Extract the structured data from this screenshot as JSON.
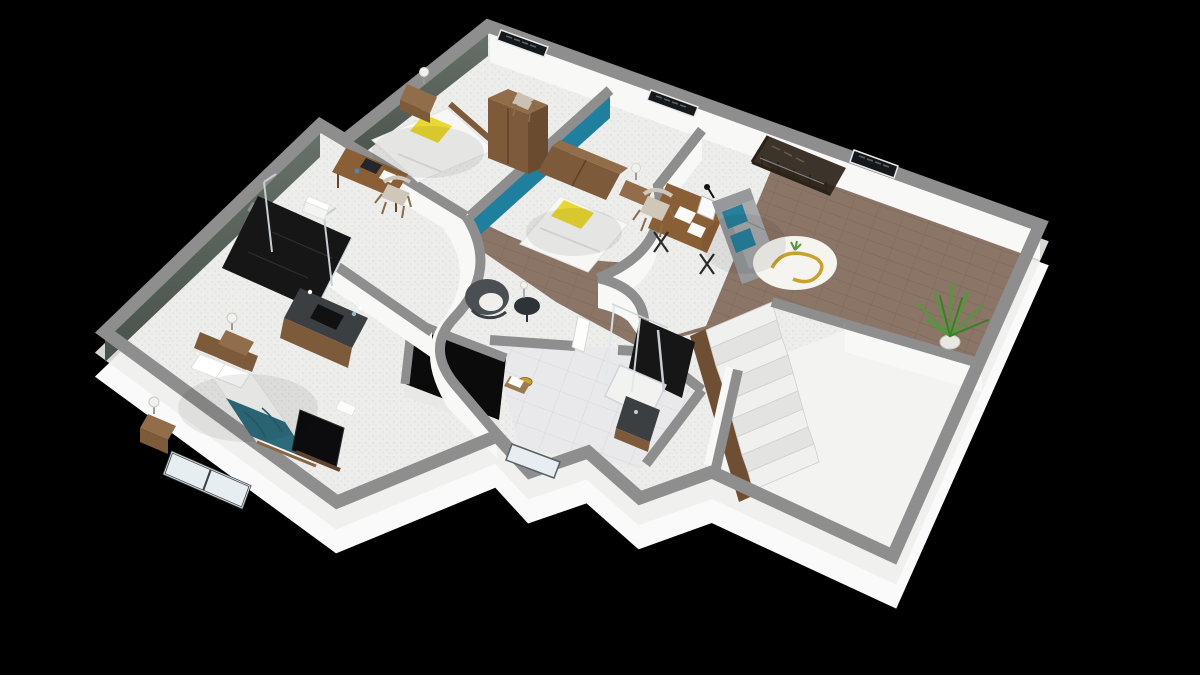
{
  "scene": {
    "type": "isometric-3d-floor-plan",
    "description": "3D dollhouse cutaway render of an upper storey, viewed from above at an angle on a black background",
    "background": "#000000",
    "level": "upper floor with stair landing"
  },
  "palette": {
    "background": "#000000",
    "wall-top": "#8e8e8e",
    "wall-face": "#f8f8f7",
    "plinth": "#fafafa",
    "floor-white": "#ededeb",
    "floor-speckle": "#d9d9d6",
    "wood-floor": "#8b7566",
    "wood-line": "#79665a",
    "tile-floor": "#e9e9eb",
    "tile-line": "#d7d7da",
    "empty-room-floor": "#f3f3f1",
    "sage-wall": "#5e6a61",
    "sage-wall-dark": "#49524b",
    "teal-wall": "#1e7f9f",
    "yellow-pillow": "#e9d832",
    "bed-white": "#f7f7f5",
    "blanket-teal": "#2e6b7a",
    "wood-furniture": "#7c5a3a",
    "wood-furniture-light": "#926d49",
    "sofa-gray": "#97989a",
    "sofa-seat": "#a8a9ab",
    "teal-pillow": "#26809b",
    "shower-black": "#161616",
    "chrome": "#c9cdd2",
    "glass": "#e6eef1",
    "stair-tread": "#f0f0ef",
    "stair-tread-alt": "#e3e3e1",
    "stair-stringer": "#6f4f33",
    "railing-dark": "#2b2218",
    "plant-green": "#55973c",
    "plant-green-dark": "#3f7a2c",
    "gold": "#c9a22a",
    "armchair-gray": "#4b4e52",
    "cushion-white": "#f0efec",
    "tv-black": "#0c0c0e",
    "counter-dark": "#3c3f42",
    "rug-white": "#f6f4ef"
  },
  "rooms": [
    {
      "id": "bedroom-1",
      "label": "bedroom 1 (top left)",
      "floor": "white speckled",
      "items": [
        "single bed, white duvet, yellow pillow",
        "nightstand with lamp",
        "desk with papers and laptop",
        "chair",
        "tall wardrobe",
        "high chair"
      ]
    },
    {
      "id": "bedroom-2",
      "label": "bedroom 2 (top middle)",
      "floor": "white speckled",
      "items": [
        "single bed, white duvet, yellow pillow",
        "tall wood headboard against teal accent wall",
        "nightstand with lamp"
      ]
    },
    {
      "id": "study-lounge",
      "label": "open study / lounge",
      "floor": "white speckled",
      "items": [
        "desk with monitor, papers and black lamp",
        "chair",
        "gray sofa with two teal pillows"
      ]
    },
    {
      "id": "living-landing",
      "label": "living landing (right wing)",
      "floor": "wood planks",
      "items": [
        "round white rug with bronze spiral sculpture",
        "potted plant",
        "stair void with dark glass railing"
      ]
    },
    {
      "id": "bathroom",
      "label": "bathroom (left)",
      "floor": "white speckled",
      "items": [
        "black tiled walk-in shower with chrome posts",
        "dark counter vanity with sink",
        "towel stack"
      ]
    },
    {
      "id": "master-bedroom",
      "label": "master bedroom (bottom left)",
      "floor": "white speckled",
      "items": [
        "double bed with teal throw blanket",
        "two nightstands with ball lamps",
        "TV leaning on stand",
        "large window on lower wall"
      ]
    },
    {
      "id": "shower-room",
      "label": "shower room (bottom middle)",
      "floor": "light tile",
      "items": [
        "glass shower with dark back panel and white tray",
        "dark vanity",
        "wood stool with towel",
        "open white door",
        "small window"
      ]
    },
    {
      "id": "hallway-nook",
      "label": "hallway reading nook with curved walls",
      "floor": "white speckled",
      "items": [
        "dark tub armchair with white cushion",
        "round side table with lamp",
        "gold floor dish",
        "black stair void"
      ]
    },
    {
      "id": "staircase",
      "label": "staircase down",
      "items": [
        "nine white treads",
        "dark wood stringer wall"
      ]
    },
    {
      "id": "empty-room",
      "label": "empty white room (bottom right)",
      "floor": "plain white",
      "items": []
    }
  ]
}
